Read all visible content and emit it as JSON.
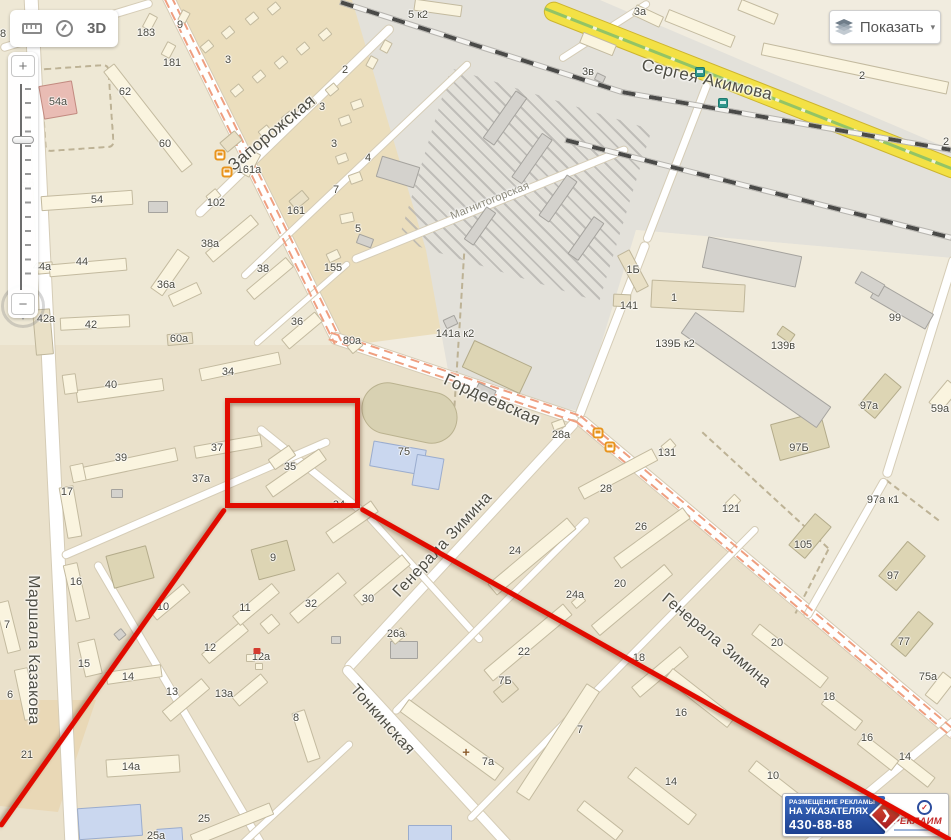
{
  "ui": {
    "toolbar": {
      "label_3d": "3D"
    },
    "show_button": {
      "label": "Показать",
      "caret": "▾"
    },
    "zoom": {
      "plus": "+",
      "minus": "−"
    },
    "ad": {
      "line1": "РАЗМЕЩЕНИЕ РЕКЛАМЫ",
      "line2": "НА УКАЗАТЕЛЯХ",
      "phone": "430-88-88",
      "brand": "РЕКЛАИМ",
      "arrow": "❯",
      "logo_mark": "✓"
    }
  },
  "map": {
    "streets": [
      {
        "name": "Запорожская",
        "x": 272,
        "y": 133,
        "rot": -40,
        "size": 17
      },
      {
        "name": "Сергея Акимова",
        "x": 707,
        "y": 80,
        "rot": 13,
        "size": 17
      },
      {
        "name": "Магнитогорская",
        "x": 490,
        "y": 201,
        "rot": -22,
        "size": 11,
        "muted": true
      },
      {
        "name": "Гордеевская",
        "x": 492,
        "y": 400,
        "rot": 24,
        "size": 17
      },
      {
        "name": "Генерала Зимина",
        "x": 443,
        "y": 545,
        "rot": -47,
        "size": 16
      },
      {
        "name": "Генерала Зимина",
        "x": 716,
        "y": 641,
        "rot": 40,
        "size": 16
      },
      {
        "name": "Тонкинская",
        "x": 382,
        "y": 720,
        "rot": 48,
        "size": 16
      },
      {
        "name": "Маршала Казакова",
        "x": 33,
        "y": 650,
        "rot": 90,
        "size": 16
      }
    ],
    "house_numbers": [
      {
        "n": "183",
        "x": 146,
        "y": 33
      },
      {
        "n": "9",
        "x": 180,
        "y": 25
      },
      {
        "n": "181",
        "x": 172,
        "y": 63
      },
      {
        "n": "3",
        "x": 228,
        "y": 60
      },
      {
        "n": "2",
        "x": 345,
        "y": 70
      },
      {
        "n": "3",
        "x": 322,
        "y": 107
      },
      {
        "n": "3",
        "x": 334,
        "y": 144
      },
      {
        "n": "4",
        "x": 368,
        "y": 158
      },
      {
        "n": "7",
        "x": 336,
        "y": 190
      },
      {
        "n": "5",
        "x": 358,
        "y": 229
      },
      {
        "n": "161а",
        "x": 249,
        "y": 170
      },
      {
        "n": "161",
        "x": 296,
        "y": 211
      },
      {
        "n": "102",
        "x": 216,
        "y": 203
      },
      {
        "n": "60",
        "x": 165,
        "y": 144
      },
      {
        "n": "62",
        "x": 125,
        "y": 92
      },
      {
        "n": "54а",
        "x": 58,
        "y": 102
      },
      {
        "n": "54",
        "x": 97,
        "y": 200
      },
      {
        "n": "56",
        "x": 28,
        "y": 183,
        "muted": true
      },
      {
        "n": "8",
        "x": 3,
        "y": 34
      },
      {
        "n": "44а",
        "x": 42,
        "y": 267
      },
      {
        "n": "44",
        "x": 82,
        "y": 262
      },
      {
        "n": "38а",
        "x": 210,
        "y": 244
      },
      {
        "n": "36а",
        "x": 166,
        "y": 285
      },
      {
        "n": "42а",
        "x": 46,
        "y": 319
      },
      {
        "n": "42",
        "x": 91,
        "y": 325
      },
      {
        "n": "60а",
        "x": 179,
        "y": 339
      },
      {
        "n": "34",
        "x": 228,
        "y": 372
      },
      {
        "n": "40",
        "x": 111,
        "y": 385
      },
      {
        "n": "38",
        "x": 263,
        "y": 269
      },
      {
        "n": "36",
        "x": 297,
        "y": 322
      },
      {
        "n": "80а",
        "x": 352,
        "y": 341
      },
      {
        "n": "155",
        "x": 333,
        "y": 268
      },
      {
        "n": "37",
        "x": 217,
        "y": 448
      },
      {
        "n": "37а",
        "x": 201,
        "y": 479
      },
      {
        "n": "39",
        "x": 121,
        "y": 458
      },
      {
        "n": "17",
        "x": 67,
        "y": 492
      },
      {
        "n": "35",
        "x": 290,
        "y": 467
      },
      {
        "n": "34",
        "x": 339,
        "y": 505
      },
      {
        "n": "75",
        "x": 404,
        "y": 452
      },
      {
        "n": "16",
        "x": 76,
        "y": 582
      },
      {
        "n": "15",
        "x": 84,
        "y": 664
      },
      {
        "n": "14",
        "x": 128,
        "y": 677
      },
      {
        "n": "13",
        "x": 172,
        "y": 692
      },
      {
        "n": "13а",
        "x": 224,
        "y": 694
      },
      {
        "n": "12",
        "x": 210,
        "y": 648
      },
      {
        "n": "11",
        "x": 245,
        "y": 608
      },
      {
        "n": "10",
        "x": 163,
        "y": 607
      },
      {
        "n": "6",
        "x": 10,
        "y": 695
      },
      {
        "n": "7",
        "x": 7,
        "y": 625
      },
      {
        "n": "21",
        "x": 27,
        "y": 755
      },
      {
        "n": "14а",
        "x": 131,
        "y": 767
      },
      {
        "n": "25",
        "x": 204,
        "y": 819
      },
      {
        "n": "25а",
        "x": 156,
        "y": 836
      },
      {
        "n": "12а",
        "x": 261,
        "y": 657
      },
      {
        "n": "8",
        "x": 296,
        "y": 718
      },
      {
        "n": "9",
        "x": 273,
        "y": 558
      },
      {
        "n": "32",
        "x": 311,
        "y": 604
      },
      {
        "n": "30",
        "x": 368,
        "y": 599
      },
      {
        "n": "26а",
        "x": 396,
        "y": 634
      },
      {
        "n": "22",
        "x": 524,
        "y": 652
      },
      {
        "n": "7Б",
        "x": 505,
        "y": 681
      },
      {
        "n": "7а",
        "x": 488,
        "y": 762
      },
      {
        "n": "7",
        "x": 580,
        "y": 730
      },
      {
        "n": "24",
        "x": 515,
        "y": 551
      },
      {
        "n": "24а",
        "x": 575,
        "y": 595
      },
      {
        "n": "20",
        "x": 620,
        "y": 584
      },
      {
        "n": "26",
        "x": 641,
        "y": 527
      },
      {
        "n": "28",
        "x": 606,
        "y": 489
      },
      {
        "n": "28а",
        "x": 561,
        "y": 435
      },
      {
        "n": "18",
        "x": 639,
        "y": 658
      },
      {
        "n": "20",
        "x": 777,
        "y": 643
      },
      {
        "n": "18",
        "x": 829,
        "y": 697
      },
      {
        "n": "16",
        "x": 867,
        "y": 738
      },
      {
        "n": "14",
        "x": 905,
        "y": 757
      },
      {
        "n": "10",
        "x": 773,
        "y": 776
      },
      {
        "n": "14",
        "x": 671,
        "y": 782
      },
      {
        "n": "16",
        "x": 681,
        "y": 713
      },
      {
        "n": "75а",
        "x": 928,
        "y": 677
      },
      {
        "n": "77",
        "x": 904,
        "y": 642
      },
      {
        "n": "131",
        "x": 667,
        "y": 453
      },
      {
        "n": "121",
        "x": 731,
        "y": 509
      },
      {
        "n": "105",
        "x": 803,
        "y": 545
      },
      {
        "n": "97Б",
        "x": 799,
        "y": 448
      },
      {
        "n": "97а к1",
        "x": 883,
        "y": 500
      },
      {
        "n": "97",
        "x": 893,
        "y": 576
      },
      {
        "n": "97а",
        "x": 869,
        "y": 406
      },
      {
        "n": "59а",
        "x": 940,
        "y": 409
      },
      {
        "n": "99",
        "x": 895,
        "y": 318
      },
      {
        "n": "139в",
        "x": 783,
        "y": 346
      },
      {
        "n": "139Б к2",
        "x": 675,
        "y": 344
      },
      {
        "n": "1Б",
        "x": 633,
        "y": 270
      },
      {
        "n": "141",
        "x": 629,
        "y": 306
      },
      {
        "n": "1",
        "x": 674,
        "y": 298
      },
      {
        "n": "141а к2",
        "x": 455,
        "y": 334
      },
      {
        "n": "3а",
        "x": 640,
        "y": 12
      },
      {
        "n": "5 к2",
        "x": 418,
        "y": 15
      },
      {
        "n": "3в",
        "x": 588,
        "y": 72
      },
      {
        "n": "2",
        "x": 862,
        "y": 76
      },
      {
        "n": "2",
        "x": 946,
        "y": 142
      }
    ],
    "transit": [
      {
        "type": "tram",
        "x": 220,
        "y": 155
      },
      {
        "type": "tram",
        "x": 227,
        "y": 172
      },
      {
        "type": "tram",
        "x": 598,
        "y": 433
      },
      {
        "type": "tram",
        "x": 610,
        "y": 447
      },
      {
        "type": "bus",
        "x": 700,
        "y": 72
      },
      {
        "type": "bus",
        "x": 723,
        "y": 103
      }
    ],
    "poi": [
      {
        "type": "pharmacy",
        "x": 466,
        "y": 752
      },
      {
        "type": "shop",
        "x": 257,
        "y": 651
      }
    ],
    "highlight": {
      "color": "#e10b00",
      "rect": {
        "x": 225,
        "y": 398,
        "w": 135,
        "h": 110
      },
      "lines": [
        [
          225,
          508,
          0,
          826
        ],
        [
          360,
          508,
          951,
          840
        ]
      ]
    }
  },
  "colors": {
    "accent_red": "#e10b00",
    "road_yellow": "#f3e145",
    "tram_line": "#ef9f80",
    "blue_building": "#cad7ef"
  }
}
